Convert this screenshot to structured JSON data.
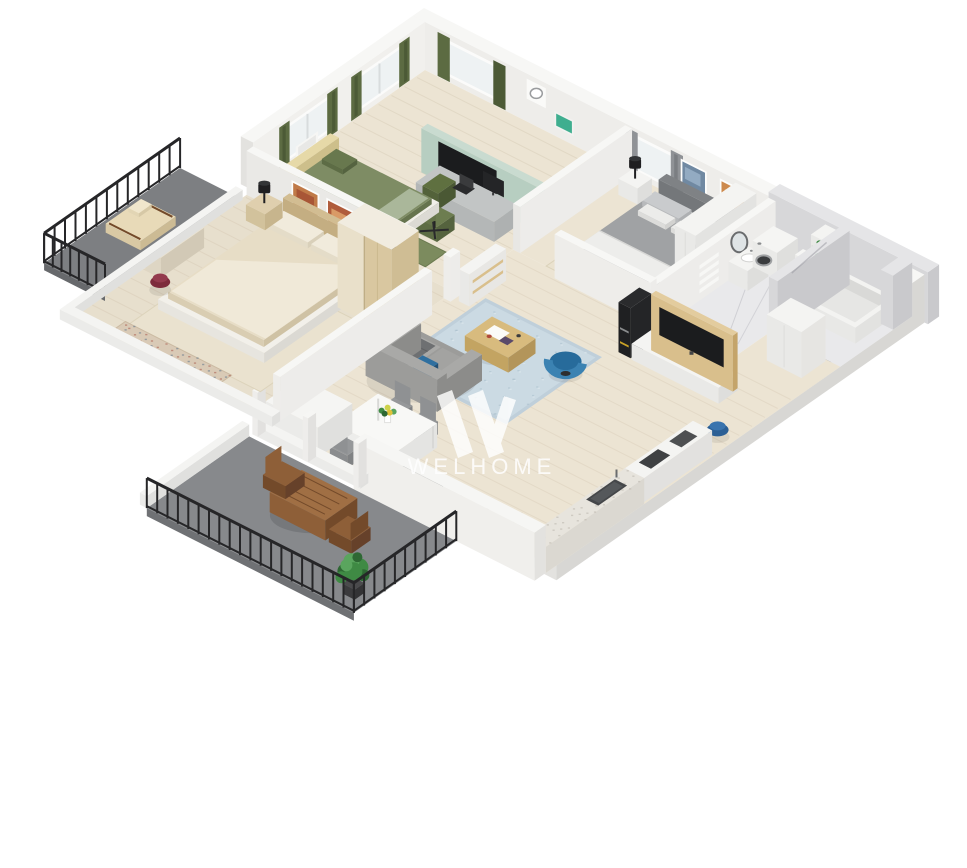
{
  "title": "3D isometric apartment floor plan render",
  "watermark": {
    "brand": "WELHOME",
    "logo": "welhome-w-logo"
  },
  "palette": {
    "bg": "#ffffff",
    "wall_top": "#f7f7f5",
    "wall_light": "#eeedea",
    "wall_mid": "#e3e2df",
    "wall_dark": "#d8d7d4",
    "wall_inner": "#edecea",
    "wall_bright": "#f1f0ed",
    "marble": "#d7d7d9",
    "marble_light": "#e5e5e7",
    "marble_dark": "#c9c9cc",
    "floor_wood": "#ece4d3",
    "floor_wood2": "#e7dfcd",
    "floor_marble": "#e9e9eb",
    "floor_terrace": "#87898c",
    "floor_balcony": "#7d7f82",
    "pane": "#eef2f3",
    "frame": "#fbfbfa",
    "curtain_green": "#5c6b42",
    "curtain_green_dark": "#4c5a36",
    "curtain_gray": "#8f9296",
    "curtain_gray_dark": "#7b7e82",
    "mint": "#b7cec1",
    "mint_top": "#c9dbd0",
    "mint_side": "#a5bcaf",
    "tv_black": "#1b1c1e",
    "tv_dark": "#2a2b2d",
    "desk_top": "#c2c5c5",
    "desk_side": "#aeb1b1",
    "chair_green": "#6d7d50",
    "chair_green_dark": "#5d6c44",
    "green_unit": "#3fae8f",
    "bed_green": "#7e8c64",
    "bed_green_light": "#aab79a",
    "pillow_green": "#68784e",
    "headboard_yellow": "#e6d9a8",
    "bed_gray": "#a0a2a4",
    "bed_gray_dark": "#7f8285",
    "sheet_white": "#ededeb",
    "pillow_gray": "#c9cbcd",
    "white_furn": "#f4f4f2",
    "white_face": "#e9e9e7",
    "white_dark": "#dededc",
    "beige_bed": "#e7ddc6",
    "beige_light": "#f0e9d8",
    "beige_mid": "#dfcfae",
    "beige_dark": "#d2bd92",
    "wood_warm": "#d9bf8c",
    "wood_warm_dark": "#c4a46a",
    "sofa": "#9c9c9a",
    "sofa_dark": "#8c8c8a",
    "sofa_light": "#a9a9a7",
    "throw": "#6e7072",
    "pillow_blue": "#2f6f9f",
    "coffee_wood": "#d8bb7e",
    "coffee_wood_dark": "#c3a462",
    "chair_blue": "#276b9b",
    "chair_blue_light": "#3b82b2",
    "rug_blue": "#bfcfda",
    "rug_blue_light": "#cbdae3",
    "rug_blue_dark": "#a9bfcc",
    "rug_blue_pale": "#e2ebf0",
    "rug_beige": "#eae2cf",
    "rug_beige_dark": "#d9cab6",
    "pouf_blue": "#2b5f95",
    "pouf_blue_light": "#3a74ae",
    "pouf_burgundy": "#7d2b3c",
    "pouf_burgundy_light": "#933a4d",
    "counter": "#e7e4dd",
    "speck": "#b9b5ab",
    "appl_dark": "#3c3e40",
    "appl_mid": "#515356",
    "door_dark": "#57585c",
    "wood_out": "#8e5f38",
    "wood_out_dark": "#734a2a",
    "wood_out_light": "#a06f44",
    "plant_dark": "#2e6833",
    "plant_mid": "#3f8a44",
    "plant_light": "#5aa55e",
    "pot": "#3b3b3d",
    "railing": "#262628",
    "art_blue": "#7089a2",
    "art_blue2": "#93abc2",
    "art_orange": "#cd8a4e",
    "art_orange2": "#e2aa6e",
    "art_warm": "#c07a48",
    "art_warm2": "#a85636",
    "lamp_black": "#1f1f21",
    "shadow": "rgba(0,0,0,0.08)",
    "watermark": "#ffffff"
  },
  "rooms": [
    {
      "name": "home-office-bedroom",
      "furniture": [
        "desk",
        "laptop",
        "monitor",
        "office-chair-green",
        "drawer-unit-green",
        "single-bed-green",
        "green-curtains",
        "windows",
        "radiator",
        "wall-clock",
        "wall-shelf-teal",
        "mint-partition",
        "partition-tv",
        "green-rug"
      ]
    },
    {
      "name": "master-bedroom",
      "furniture": [
        "double-bed-gray",
        "nightstand-white",
        "table-lamp-black",
        "wall-art-blue",
        "wall-art-orange",
        "gray-curtains",
        "wardrobe-white",
        "rug-beige"
      ]
    },
    {
      "name": "bathroom",
      "furniture": [
        "washing-machine",
        "toilet",
        "shelving-unit",
        "sink-vanity",
        "round-mirror",
        "towel-radiator",
        "bathtub",
        "marble-walls"
      ]
    },
    {
      "name": "entry-hall",
      "furniture": [
        "entry-door-dark",
        "closet-white"
      ]
    },
    {
      "name": "living-room",
      "furniture": [
        "sofa-gray",
        "blue-pillow",
        "gray-throw",
        "coffee-table-wood",
        "armchair-blue",
        "area-rug-blue",
        "tv-unit-wood-panel",
        "flatscreen-tv",
        "black-shelf-column",
        "console-shelf",
        "pouf-blue",
        "sideboard-white"
      ]
    },
    {
      "name": "kitchen",
      "furniture": [
        "counter-right",
        "sink-dark",
        "counter-bottom",
        "cooktop-burners",
        "island-white"
      ]
    },
    {
      "name": "dining-area",
      "furniture": [
        "dining-table-white",
        "dining-chairs-gray",
        "flower-vase"
      ]
    },
    {
      "name": "beige-bedroom",
      "furniture": [
        "double-bed-beige",
        "nightstands-beige",
        "table-lamps-black",
        "wardrobe-beige-twotone",
        "vanity-desk",
        "standing-mirror-black",
        "pouf-burgundy",
        "wall-art-warm",
        "rug-beige",
        "runner-rug"
      ]
    },
    {
      "name": "balcony",
      "furniture": [
        "railing-black",
        "wood-lounger"
      ]
    },
    {
      "name": "terrace",
      "furniture": [
        "railing-black",
        "outdoor-table-wood",
        "outdoor-chairs-wood",
        "potted-plant"
      ]
    }
  ]
}
